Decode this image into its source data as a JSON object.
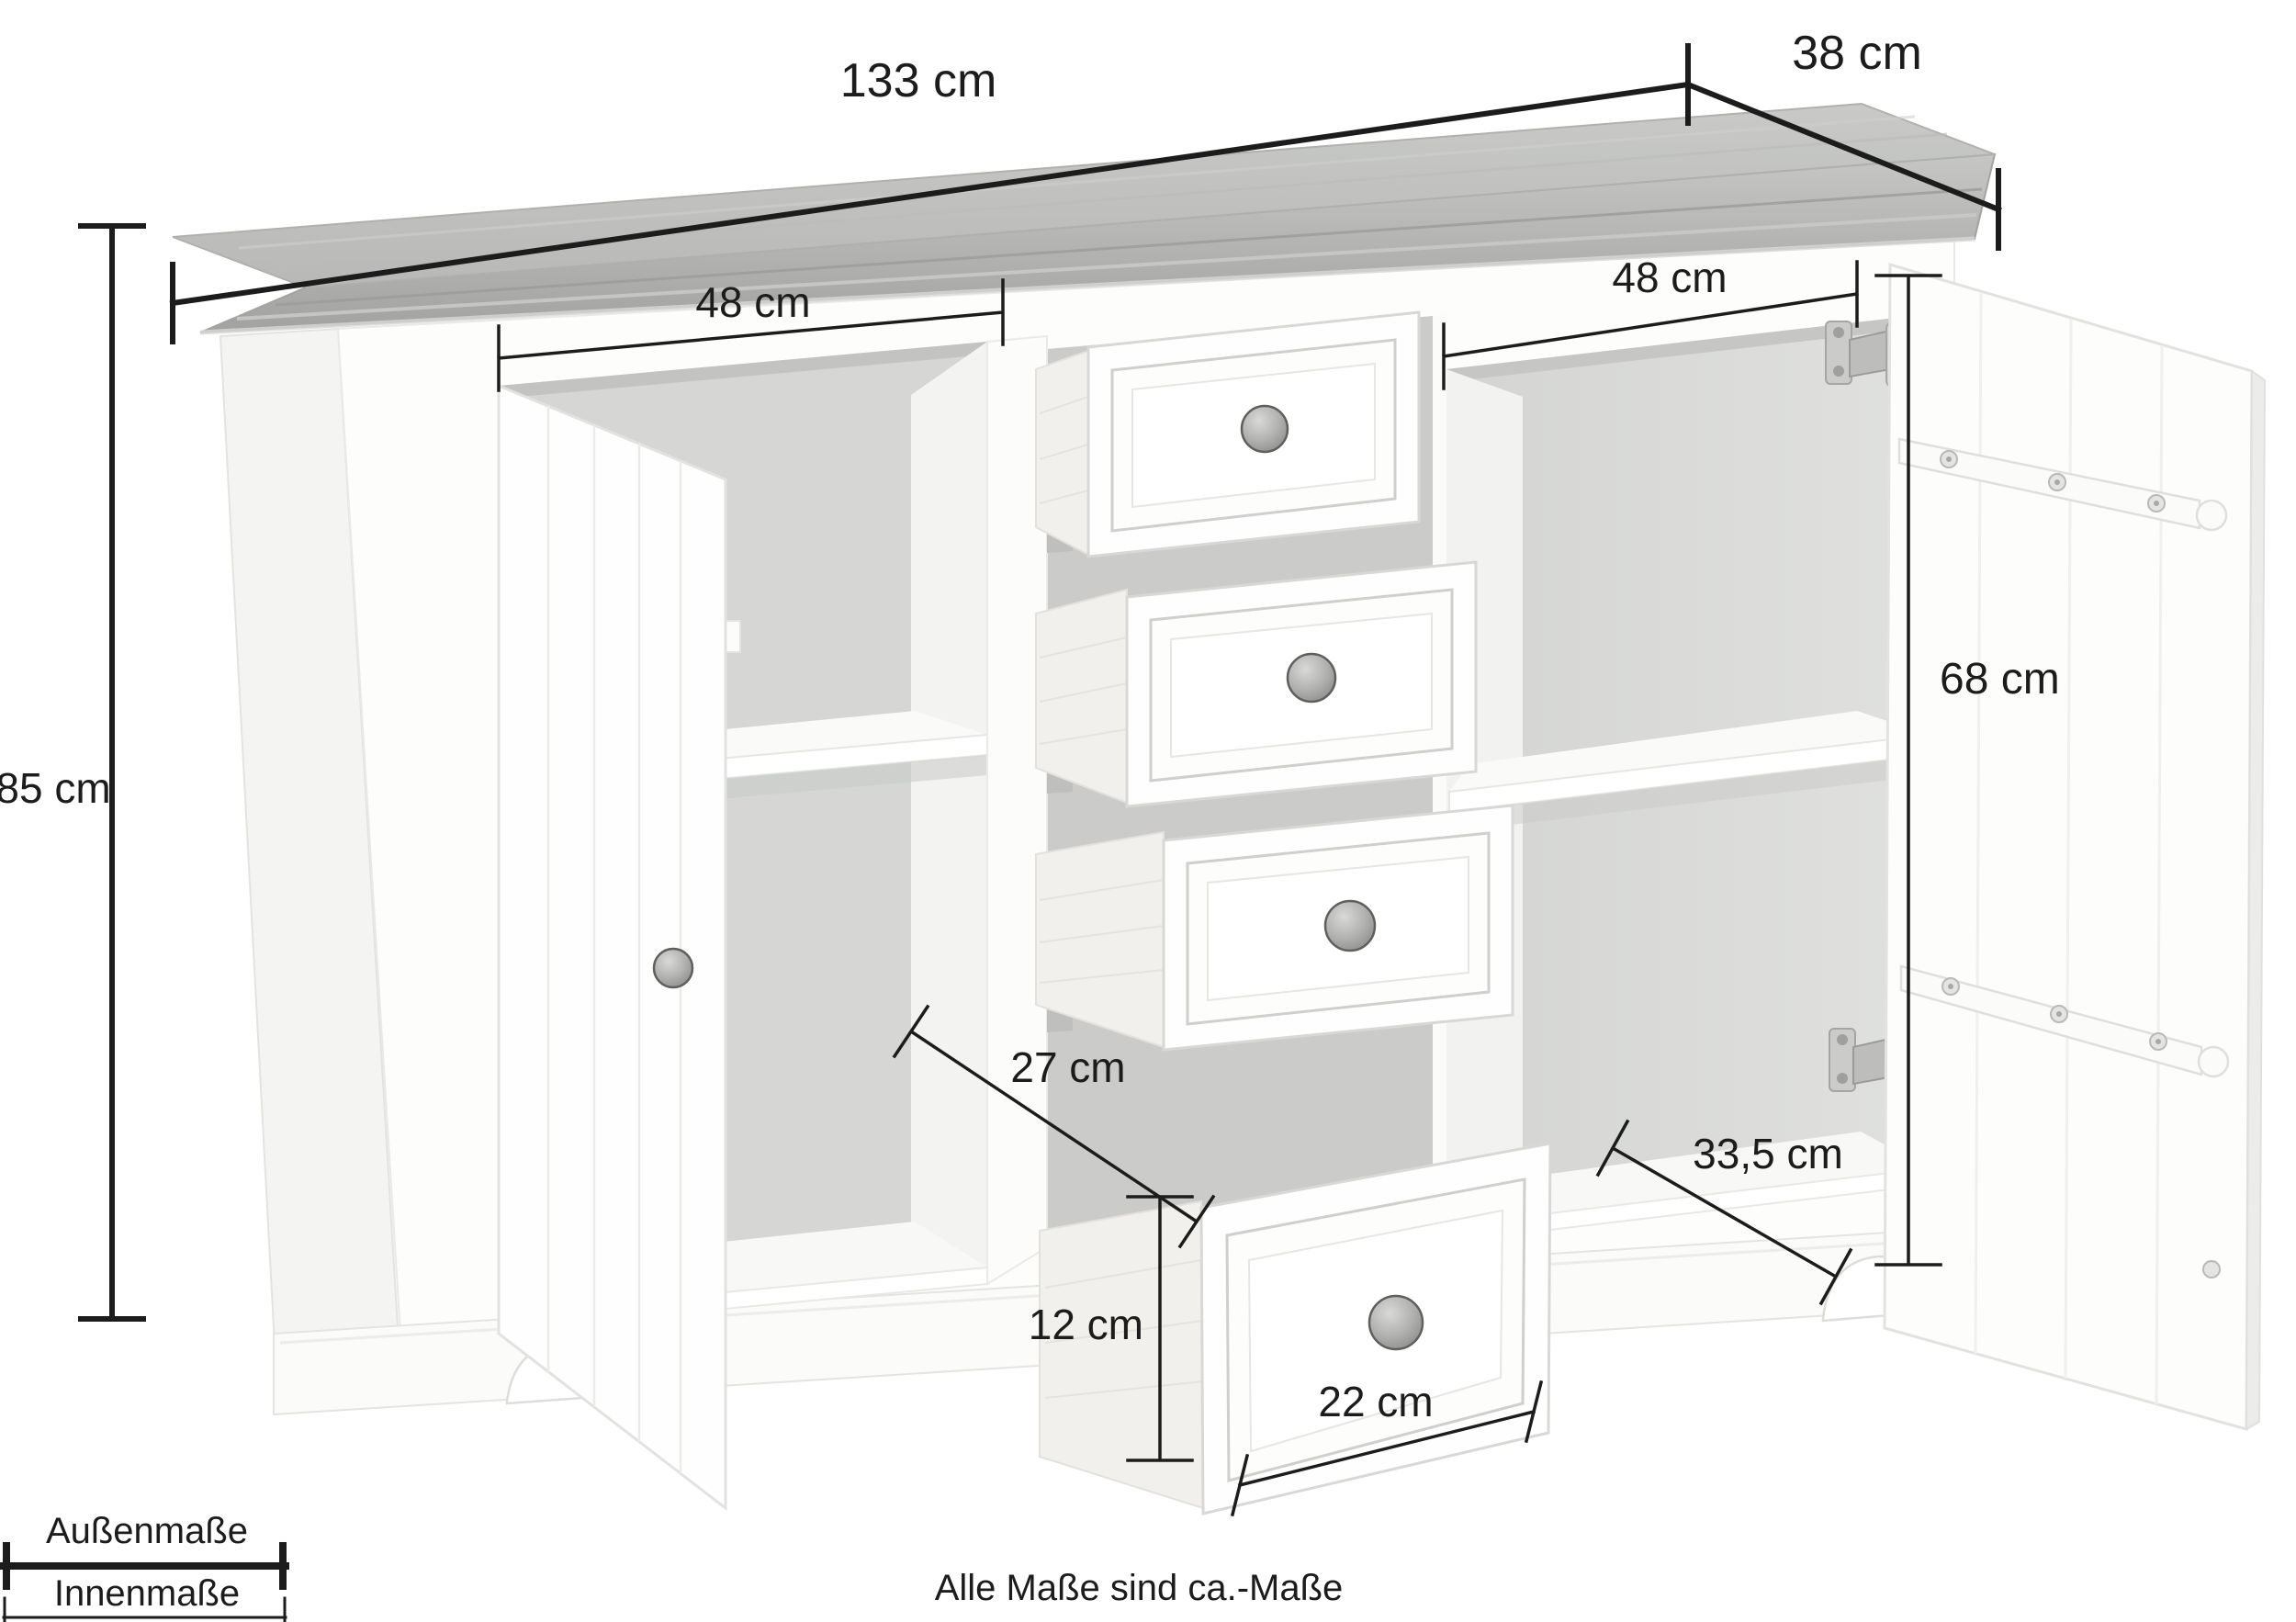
{
  "measurements": {
    "outer_width": "133 cm",
    "outer_depth": "38 cm",
    "outer_height": "85 cm",
    "inner_width_left": "48 cm",
    "inner_width_right": "48 cm",
    "door_height": "68 cm",
    "shelf_clearance": "27 cm",
    "plinth_height": "12 cm",
    "drawer_front_width": "22 cm",
    "inner_depth": "33,5 cm"
  },
  "legend": {
    "outer": "Außenmaße",
    "inner": "Innenmaße"
  },
  "footnote": "Alle Maße sind ca.-Maße",
  "colors": {
    "background": "#ffffff",
    "annotation": "#1c1c1c",
    "top_surface": "#c2c3c1",
    "top_molding": "#b0b1af",
    "body_white": "#fdfdfc",
    "interior_gray": "#d6d7d5",
    "knob_gray": "#9b9b99",
    "hinge_gray": "#c0c1bf"
  }
}
